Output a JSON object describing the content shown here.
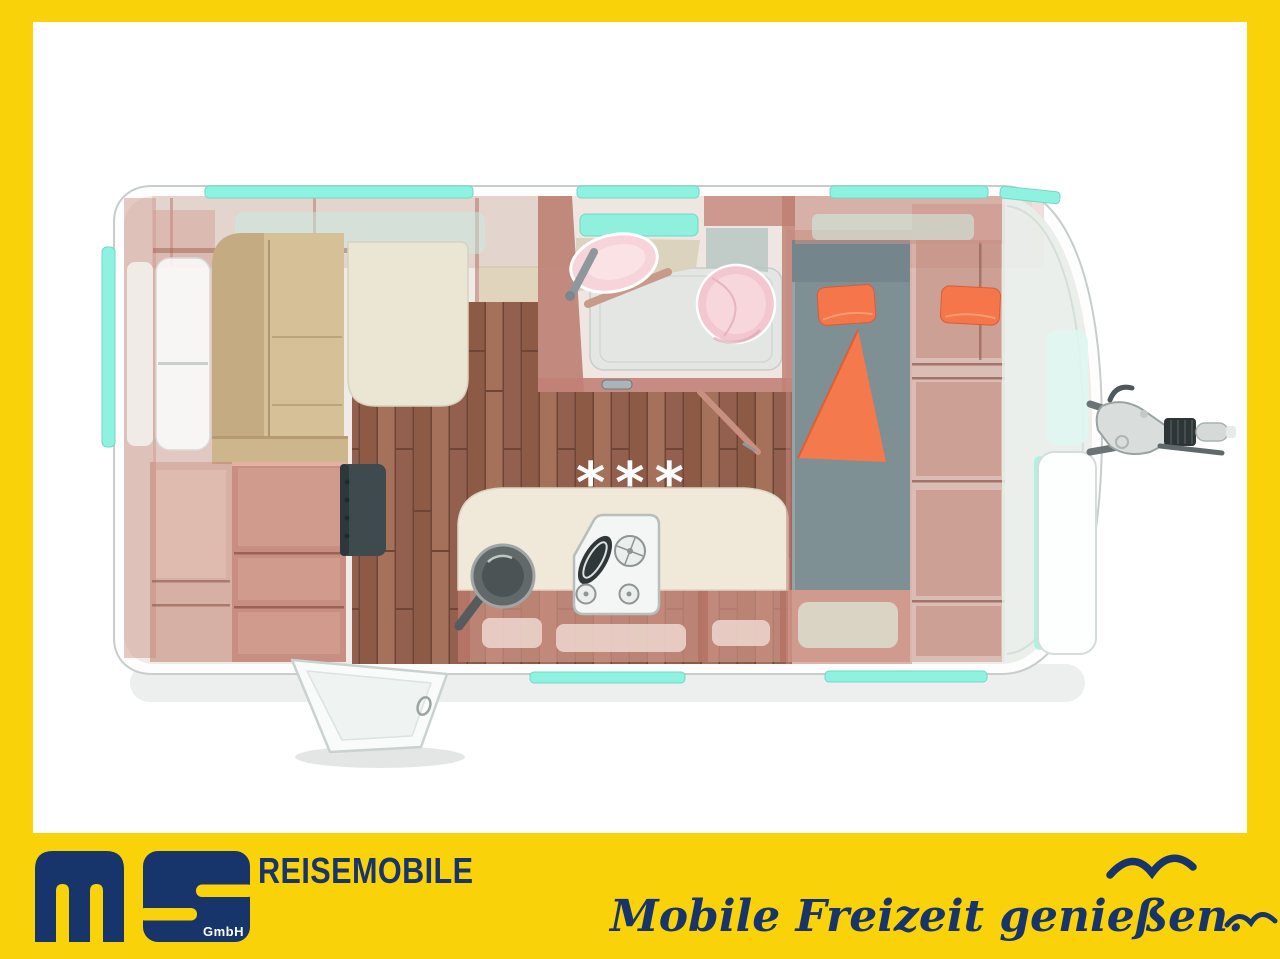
{
  "frame": {
    "border_color": "#FAD20A",
    "canvas_color": "#FFFFFF"
  },
  "floorplan": {
    "stars": "***",
    "colors": {
      "wood_cabinet": "#CE9488",
      "wood_floor": "#9A6852",
      "seat_beige": "#D5C098",
      "table_cream": "#EBE5D4",
      "window_teal": "#8FF0DE",
      "mattress_slate": "#7E9094",
      "accent_orange": "#F4764A",
      "sanitary_pink": "#F5CED5",
      "shower_gray": "#E3E6E3",
      "tv_dark": "#3E4A4E",
      "hitch_gray": "#6A7376"
    }
  },
  "footer": {
    "logo_suffix": "GmbH",
    "brand": "REISEMOBILE",
    "slogan": "Mobile Freizeit genießen.",
    "navy": "#17356B",
    "yellow": "#FAD20A"
  }
}
